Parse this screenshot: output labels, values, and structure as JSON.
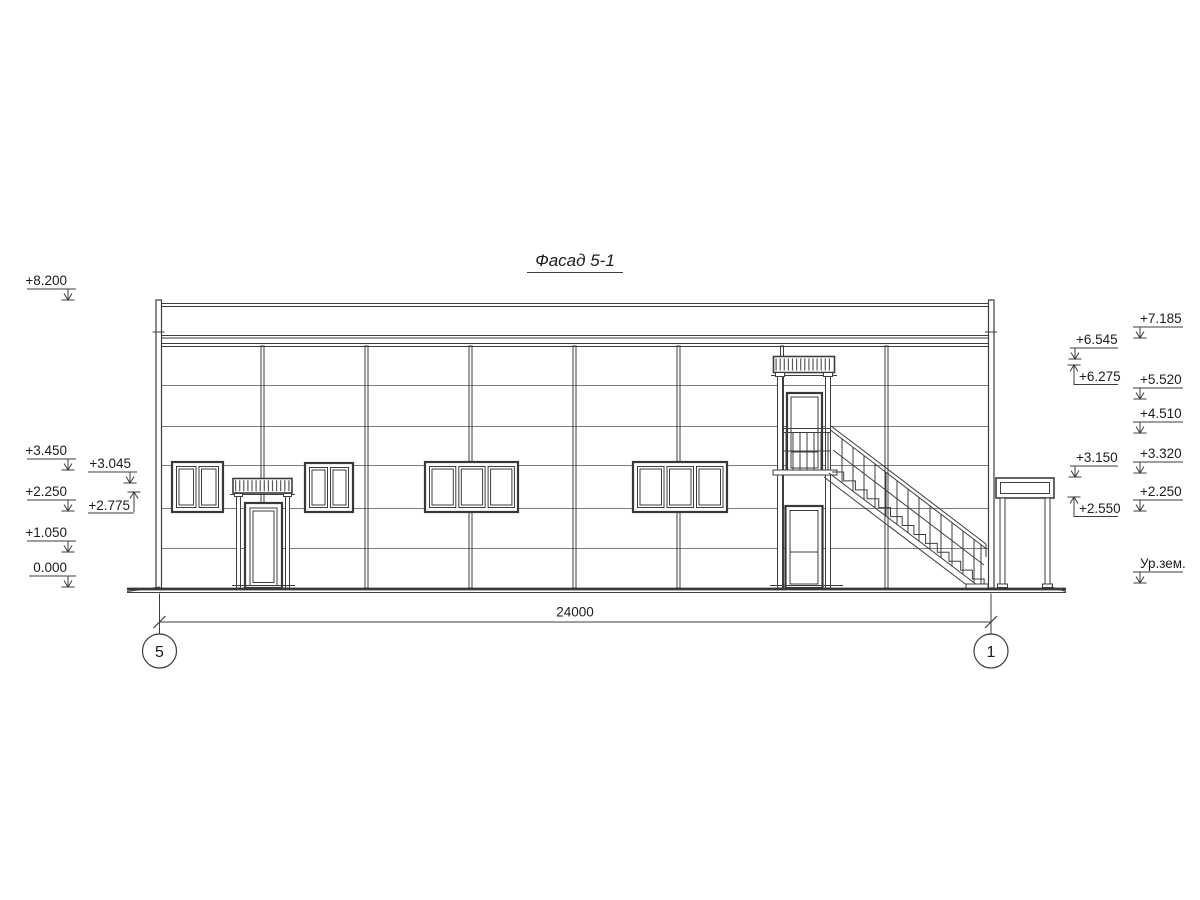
{
  "drawing": {
    "title": "Фасад 5-1",
    "dimension": {
      "total": "24000"
    },
    "axes": {
      "left": "5",
      "right": "1"
    },
    "elevations": {
      "left_outer": [
        "+8.200",
        "+3.450",
        "+2.250",
        "+1.050",
        "0.000"
      ],
      "left_inner": [
        "+3.045",
        "+2.775"
      ],
      "right_inner": [
        "+6.545",
        "+6.275",
        "+3.150",
        "+2.550"
      ],
      "right_outer": [
        "+7.185",
        "+5.520",
        "+4.510",
        "+3.320",
        "+2.250",
        "Ур.зем."
      ]
    },
    "colors": {
      "line": "#3d3d3d",
      "text": "#1c1c1c",
      "background": "#ffffff"
    }
  }
}
